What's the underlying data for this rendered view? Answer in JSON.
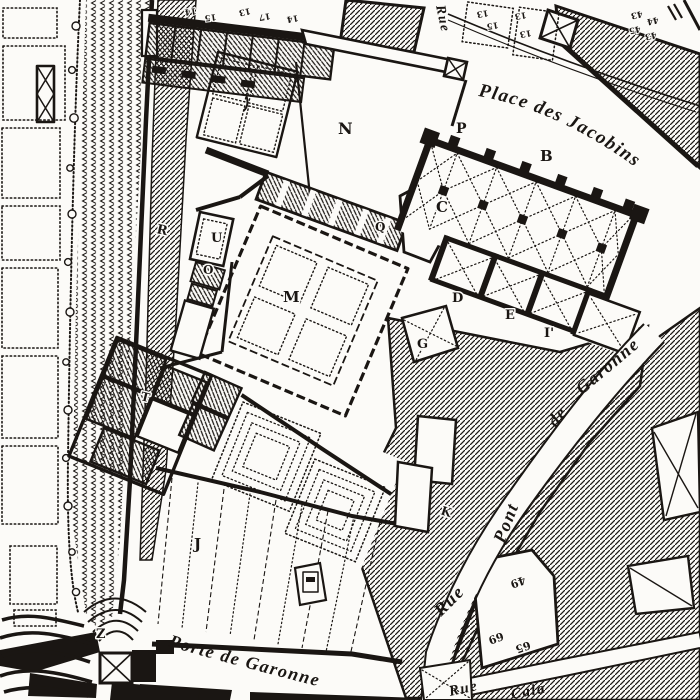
{
  "map": {
    "paper_color": "#fcfbf8",
    "ink_color": "#1a1613",
    "streets": {
      "place": "Place des Jacobins",
      "rpg_rue": "Rue",
      "rpg_pont": "Pont",
      "rpg_de": "de",
      "rpg_garonne": "Garonne",
      "porte": "Porte de Garonne",
      "rue_top": "Rue",
      "cala_rue": "Rue",
      "cala": "Cala"
    },
    "letters": {
      "B": "B",
      "C": "C",
      "D": "D",
      "E": "E",
      "G": "G",
      "I2": "I'",
      "J": "J",
      "K": "K",
      "M": "M",
      "N": "N",
      "O": "O",
      "P": "P",
      "Q": "Q",
      "R": "R",
      "T": "T",
      "U": "U",
      "Z": "Z"
    },
    "numbers": {
      "tl1": "14",
      "tl2": "15",
      "tl3": "13",
      "tl4": "17",
      "tl5": "14",
      "tr1": "13",
      "tr2": "15",
      "tr3": "13",
      "tr4": "13",
      "c1": "43",
      "c2": "44",
      "c3": "45",
      "c4": "43",
      "br49": "49",
      "br69": "69",
      "br65": "65"
    }
  }
}
